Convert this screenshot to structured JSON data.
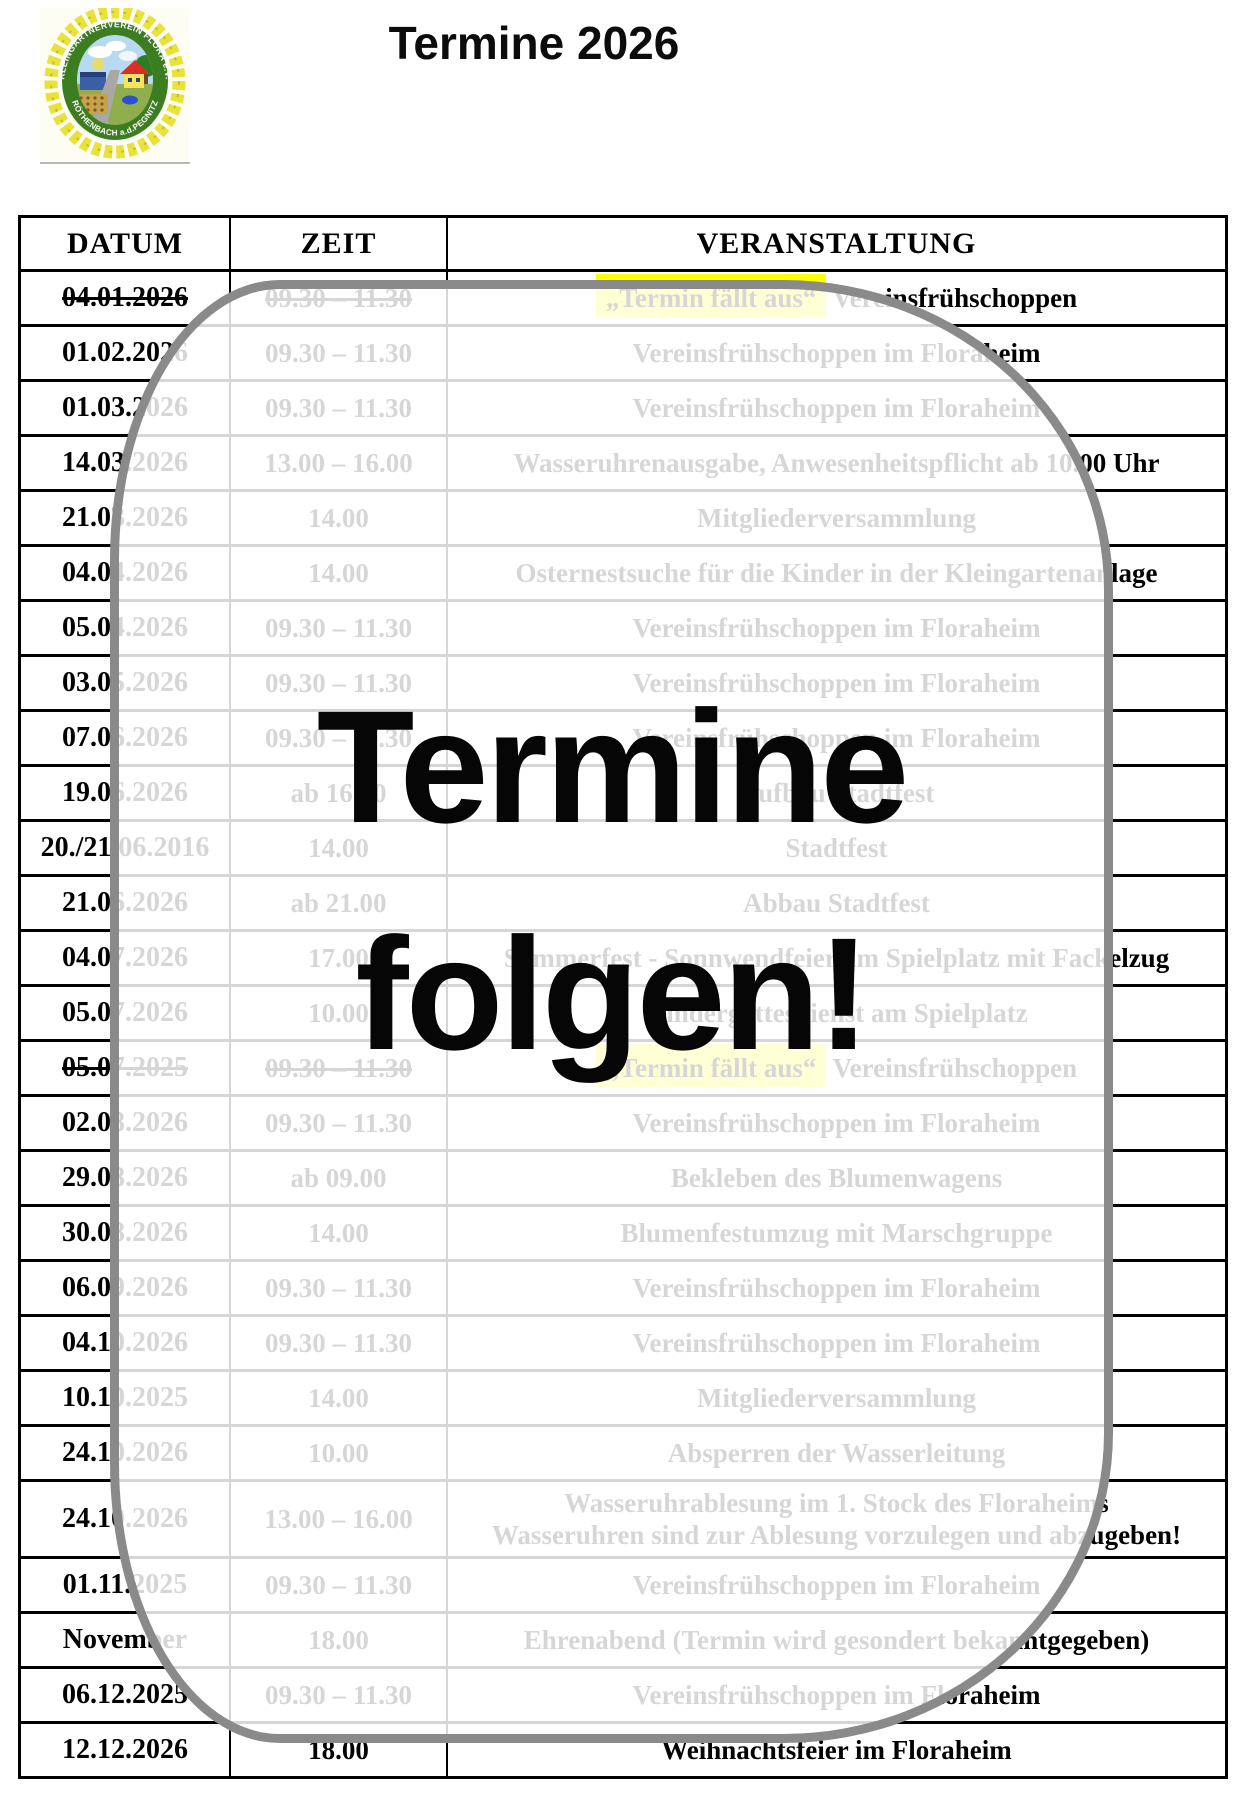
{
  "header": {
    "title": "Termine 2026"
  },
  "logo": {
    "icon": "club-emblem-logo",
    "text_top": "KLEINGÄRTNERVEREIN FLORA e.V.",
    "text_bottom": "RÖTHENBACH a.d.PEGNITZ"
  },
  "overlay": {
    "line1": "Termine",
    "line2": "folgen!",
    "border_color": "#8a8a8a"
  },
  "colors": {
    "highlight": "#ffff00",
    "table_border": "#000000"
  },
  "table": {
    "columns": [
      "DATUM",
      "ZEIT",
      "VERANSTALTUNG"
    ],
    "rows": [
      {
        "datum": "04.01.2026",
        "zeit": "09.30 – 11.30",
        "event": "Vereinsfrühschoppen",
        "event_prefix": "„Termin fällt aus“",
        "strike": true
      },
      {
        "datum": "01.02.2026",
        "zeit": "09.30 – 11.30",
        "event": "Vereinsfrühschoppen im Floraheim"
      },
      {
        "datum": "01.03.2026",
        "zeit": "09.30 – 11.30",
        "event": "Vereinsfrühschoppen im Floraheim"
      },
      {
        "datum": "14.03.2026",
        "zeit": "13.00 – 16.00",
        "event": "Wasseruhrenausgabe, Anwesenheitspflicht ab 10.00 Uhr"
      },
      {
        "datum": "21.03.2026",
        "zeit": "14.00",
        "event": "Mitgliederversammlung"
      },
      {
        "datum": "04.04.2026",
        "zeit": "14.00",
        "event": "Osternestsuche für die Kinder in der Kleingartenanlage"
      },
      {
        "datum": "05.04.2026",
        "zeit": "09.30 – 11.30",
        "event": "Vereinsfrühschoppen im Floraheim"
      },
      {
        "datum": "03.05.2026",
        "zeit": "09.30 – 11.30",
        "event": "Vereinsfrühschoppen im Floraheim"
      },
      {
        "datum": "07.06.2026",
        "zeit": "09.30 – 11.30",
        "event": "Vereinsfrühschoppen im Floraheim"
      },
      {
        "datum": "19.06.2026",
        "zeit": "ab 16.00",
        "event": "Aufbau Stadtfest"
      },
      {
        "datum": "20./21.06.2016",
        "zeit": "14.00",
        "event": "Stadtfest"
      },
      {
        "datum": "21.06.2026",
        "zeit": "ab 21.00",
        "event": "Abbau Stadtfest"
      },
      {
        "datum": "04.07.2026",
        "zeit": "17.00",
        "event": "Sommerfest - Sonnwendfeier am Spielplatz mit Fackelzug"
      },
      {
        "datum": "05.07.2026",
        "zeit": "10.00",
        "event": "Kindergottesdienst am Spielplatz"
      },
      {
        "datum": "05.07.2025",
        "zeit": "09.30 – 11.30",
        "event": "Vereinsfrühschoppen",
        "event_prefix": "„Termin fällt aus“",
        "strike": true
      },
      {
        "datum": "02.08.2026",
        "zeit": "09.30 – 11.30",
        "event": "Vereinsfrühschoppen im Floraheim"
      },
      {
        "datum": "29.08.2026",
        "zeit": "ab 09.00",
        "event": "Bekleben des Blumenwagens"
      },
      {
        "datum": "30.08.2026",
        "zeit": "14.00",
        "event": "Blumenfestumzug mit Marschgruppe"
      },
      {
        "datum": "06.09.2026",
        "zeit": "09.30 – 11.30",
        "event": "Vereinsfrühschoppen im Floraheim"
      },
      {
        "datum": "04.10.2026",
        "zeit": "09.30 – 11.30",
        "event": "Vereinsfrühschoppen im Floraheim"
      },
      {
        "datum": "10.10.2025",
        "zeit": "14.00",
        "event": "Mitgliederversammlung"
      },
      {
        "datum": "24.10.2026",
        "zeit": "10.00",
        "event": "Absperren der Wasserleitung"
      },
      {
        "datum": "24.10.2026",
        "zeit": "13.00 – 16.00",
        "event": "Wasseruhrablesung im 1. Stock des Floraheims",
        "event_line2": "Wasseruhren sind zur Ablesung vorzulegen und abzugeben!",
        "tall": true
      },
      {
        "datum": "01.11.2025",
        "zeit": "09.30 – 11.30",
        "event": "Vereinsfrühschoppen im Floraheim"
      },
      {
        "datum": "November",
        "zeit": "18.00",
        "event": "Ehrenabend (Termin wird gesondert bekanntgegeben)"
      },
      {
        "datum": "06.12.2025",
        "zeit": "09.30 – 11.30",
        "event": "Vereinsfrühschoppen im Floraheim"
      },
      {
        "datum": "12.12.2026",
        "zeit": "18.00",
        "event": "Weihnachtsfeier im Floraheim"
      }
    ]
  }
}
